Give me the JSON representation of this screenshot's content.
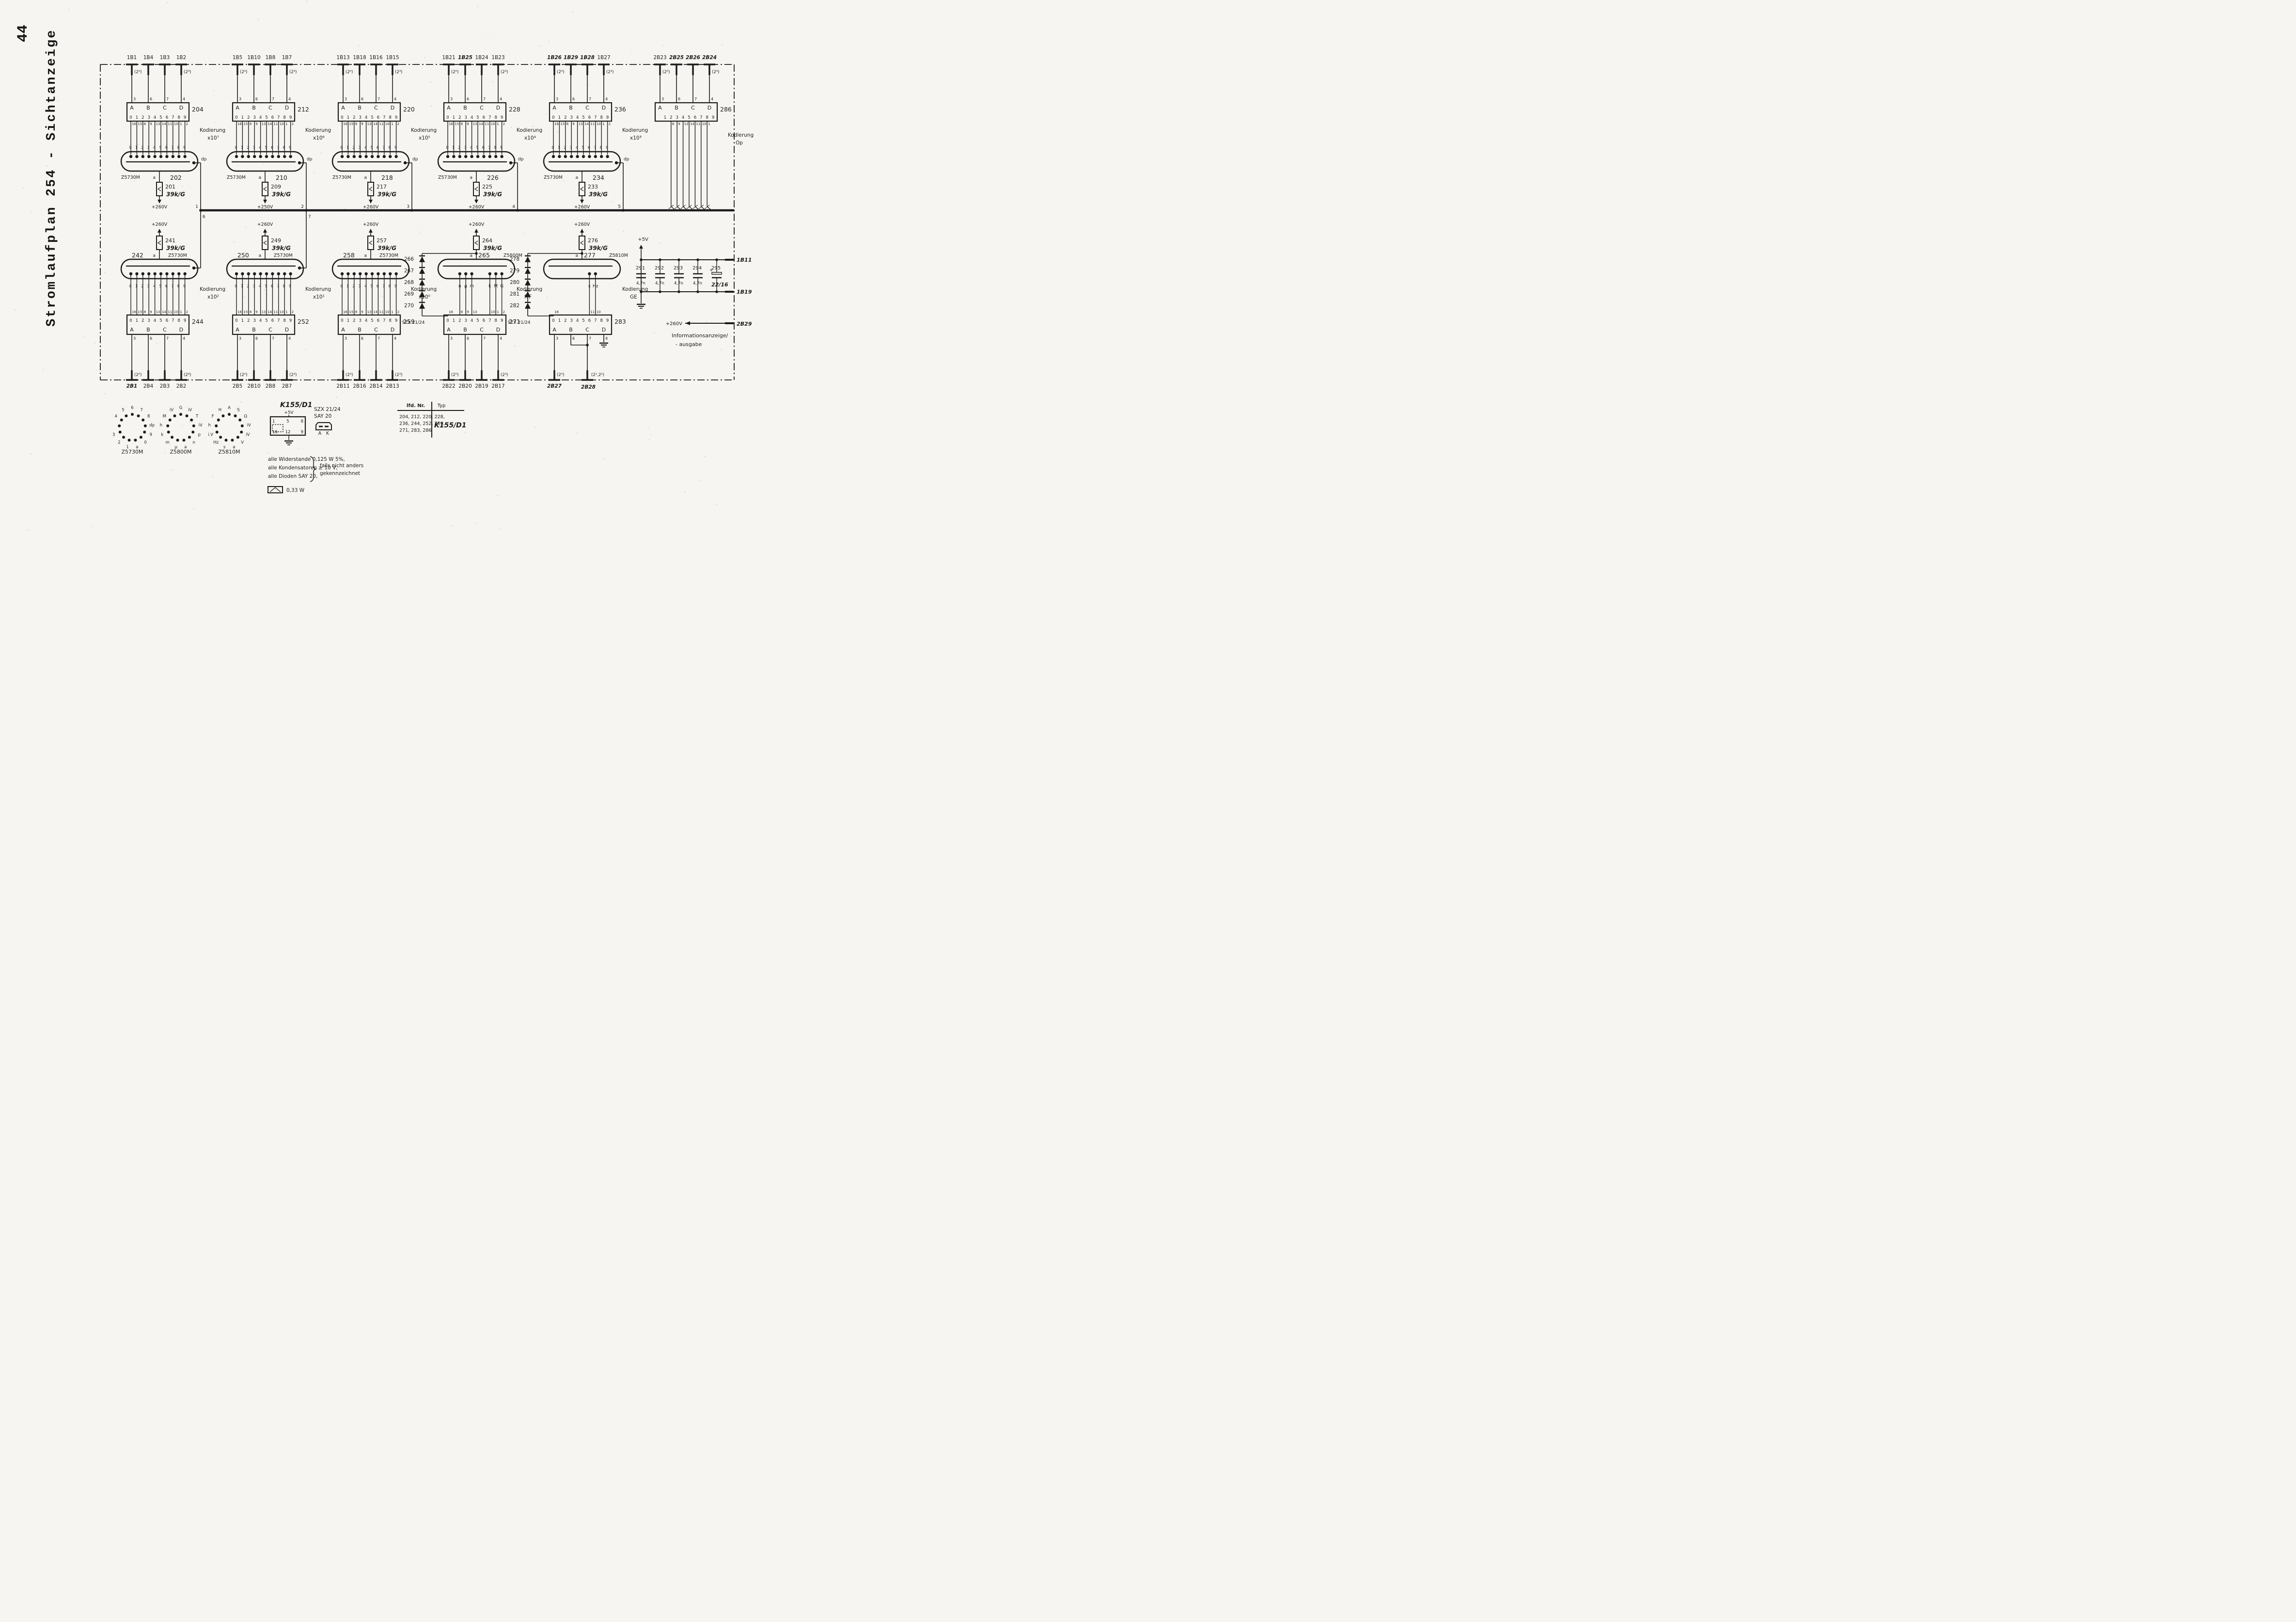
{
  "page": {
    "number": "44",
    "title": "Stromlaufplan 254  -  Sichtanzeige"
  },
  "colors": {
    "ink": "#1c1c1c",
    "paper": "#f6f5f1"
  },
  "handwritten": [
    "1B25",
    "1B26",
    "1B29",
    "1B28",
    "2B25",
    "2B26",
    "2B24",
    "2B1",
    "2B27",
    "2B28",
    "1B11",
    "1B19",
    "2B29",
    "22/16",
    "K155/D1",
    "39k/G"
  ],
  "shared": {
    "digits": [
      "0",
      "1",
      "2",
      "3",
      "4",
      "5",
      "6",
      "7",
      "8",
      "9"
    ],
    "digits9": [
      "1",
      "2",
      "3",
      "4",
      "5",
      "6",
      "7",
      "8",
      "9"
    ],
    "abcd": [
      "A",
      "B",
      "C",
      "D"
    ],
    "abcd_pins": [
      "3",
      "6",
      "7",
      "4"
    ],
    "decoder_out_pins": [
      "16",
      "15",
      "8",
      "9",
      "13",
      "14",
      "11",
      "10",
      "1",
      "2"
    ],
    "kodierung_word": "Kodierung",
    "dp": "dp",
    "anode": "a"
  },
  "bus": {
    "junctions_top": [
      "1",
      "2",
      "3",
      "4",
      "5"
    ],
    "junctions_bottom": [
      "6",
      "7"
    ]
  },
  "top_groups": [
    {
      "block": "204",
      "inputs": [
        "1B1",
        "1B4",
        "1B3",
        "1B2"
      ],
      "exp_first": "(2⁰)",
      "exp_last": "(2³)",
      "kodierung": "x10⁷",
      "tube_id": "202",
      "tube_type": "Z5730M",
      "res_id": "201",
      "res_val": "39k/G",
      "supply": "+260V",
      "junction": "1"
    },
    {
      "block": "212",
      "inputs": [
        "1B5",
        "1B10",
        "1B8",
        "1B7"
      ],
      "exp_first": "(2⁰)",
      "exp_last": "(2³)",
      "kodierung": "x10⁶",
      "tube_id": "210",
      "tube_type": "Z5730M",
      "res_id": "209",
      "res_val": "39k/G",
      "supply": "+250V",
      "junction": "2"
    },
    {
      "block": "220",
      "inputs": [
        "1B13",
        "1B18",
        "1B16",
        "1B15"
      ],
      "exp_first": "(2⁰)",
      "exp_last": "(2³)",
      "kodierung": "x10⁵",
      "tube_id": "218",
      "tube_type": "Z5730M",
      "res_id": "217",
      "res_val": "39k/G",
      "supply": "+260V",
      "junction": "3"
    },
    {
      "block": "228",
      "inputs": [
        "1B21",
        "1B25",
        "1B24",
        "1B23"
      ],
      "exp_first": "(2⁰)",
      "exp_last": "(2³)",
      "kodierung": "x10⁴",
      "tube_id": "226",
      "tube_type": "Z5730M",
      "res_id": "225",
      "res_val": "39k/G",
      "supply": "+260V",
      "junction": "4"
    },
    {
      "block": "236",
      "inputs": [
        "1B26",
        "1B29",
        "1B28",
        "1B27"
      ],
      "exp_first": "(2⁰)",
      "exp_last": "(2³)",
      "kodierung": "x10³",
      "tube_id": "234",
      "tube_type": "Z5730M",
      "res_id": "233",
      "res_val": "39k/G",
      "supply": "+260V",
      "junction": "5"
    },
    {
      "block": "286",
      "inputs": [
        "2B23",
        "2B25",
        "2B26",
        "2B24"
      ],
      "exp_first": "(2⁰)",
      "exp_last": "(2³)",
      "kodierung": "Op",
      "no_tube": true,
      "out_pins": [
        "8",
        "9",
        "13",
        "14",
        "11",
        "10",
        "1"
      ]
    }
  ],
  "bottom_groups": [
    {
      "block": "244",
      "outputs": [
        "2B1",
        "2B4",
        "2B3",
        "2B2"
      ],
      "exp_first": "(2⁰)",
      "exp_last": "(2³)",
      "kodierung": "x10²",
      "tube_id": "242",
      "tube_type": "Z5730M",
      "res_id": "241",
      "res_val": "39k/G",
      "supply": "+260V",
      "junction": "6"
    },
    {
      "block": "252",
      "outputs": [
        "2B5",
        "2B10",
        "2B8",
        "2B7"
      ],
      "exp_first": "(2⁰)",
      "exp_last": "(2³)",
      "kodierung": "x10¹",
      "tube_id": "250",
      "tube_type": "Z5730M",
      "res_id": "249",
      "res_val": "39k/G",
      "supply": "+260V",
      "junction": "7"
    },
    {
      "block": "259",
      "outputs": [
        "2B11",
        "2B16",
        "2B14",
        "2B13"
      ],
      "exp_first": "(2⁰)",
      "exp_last": "(2³)",
      "kodierung": "x10⁰",
      "tube_id": "258",
      "tube_type": "Z5730M",
      "res_id": "257",
      "res_val": "39k/G",
      "supply": "+260V"
    },
    {
      "block": "271",
      "outputs": [
        "2B22",
        "2B20",
        "2B19",
        "2B17"
      ],
      "exp_first": "(2⁰)",
      "exp_last": "(2³)",
      "kodierung": "MF",
      "tube_id": "265",
      "tube_type": "Z5800M",
      "res_id": "264",
      "res_val": "39k/G",
      "supply": "+260V",
      "cathodes": [
        "n",
        "μ",
        "m",
        "k",
        "M",
        "G"
      ],
      "cathode_pos": [
        2,
        3,
        4,
        7,
        8,
        9
      ],
      "cathode_pins": [
        "8",
        "9",
        "13",
        "10",
        "1",
        "2"
      ],
      "diodes": [
        "266",
        "267",
        "268",
        "269",
        "270"
      ],
      "diode_type": "SZX 21/24",
      "diode_pin": "16"
    },
    {
      "block": "283",
      "outputs": [
        "2B27",
        "2B28"
      ],
      "output_exps": [
        "(2⁰)",
        "(2¹,2²)"
      ],
      "kodierung": "GE",
      "tube_id": "277",
      "tube_type": "Z5810M",
      "res_id": "276",
      "res_val": "39k/G",
      "supply": "+260V",
      "cathodes": [
        "s",
        "Hz"
      ],
      "cathode_pos": [
        6,
        7
      ],
      "cathode_pins": [
        "11",
        "10"
      ],
      "diodes": [
        "278",
        "279",
        "280",
        "281",
        "282"
      ],
      "diode_type": "SZX 21/24",
      "diode_pin": "16",
      "ground_pin": "4"
    }
  ],
  "right_section": {
    "supply": "+5V",
    "caps": [
      {
        "id": "291",
        "value": "4,7n"
      },
      {
        "id": "292",
        "value": "4,7n"
      },
      {
        "id": "293",
        "value": "4,7n"
      },
      {
        "id": "294",
        "value": "4,7n"
      },
      {
        "id": "295",
        "value": "22/16",
        "polarized": true,
        "plus": "+"
      }
    ],
    "rail_top": "1B11",
    "rail_bottom": "1B19",
    "hv_label": "+260V",
    "hv_pin": "2B29",
    "info_lines": [
      "Informationsanzeige/",
      "- ausgabe"
    ]
  },
  "legend": {
    "tubes": [
      {
        "name": "Z5730M",
        "pins_cw": [
          "6",
          "7",
          "8",
          "dp",
          "9",
          "0",
          "a",
          "1",
          "2",
          "3",
          "",
          "4",
          "5"
        ]
      },
      {
        "name": "Z5800M",
        "pins_cw": [
          "G",
          "iV",
          "T",
          "iV",
          "p",
          "n",
          "a",
          "μ",
          "m",
          "k",
          "h",
          "M",
          "iV"
        ]
      },
      {
        "name": "Z5810M",
        "pins_cw": [
          "A",
          "S",
          "Ω",
          "iV",
          "iV",
          "V",
          "a",
          "s",
          "Hz",
          "i.V",
          "h",
          "F",
          "H"
        ]
      }
    ],
    "ic": {
      "name": "K155/D1",
      "supply": "+5V",
      "pins_top": [
        "1",
        "5",
        "8"
      ],
      "pins_bottom": [
        "16",
        "12",
        "9"
      ]
    },
    "diode_legend": {
      "line1": "SZX 21/24",
      "line2": "SAY 20",
      "anode": "A",
      "cathode": "K"
    },
    "table": {
      "col1": "lfd. Nr.",
      "col2": "Typ",
      "rows": [
        "204, 212, 220, 228,",
        "236, 244, 252, 259,",
        "271, 283, 286"
      ],
      "typ": "K155/D1"
    },
    "notes": {
      "lines": [
        "alle Widerstande  0,125 W  5%,",
        "alle Kondensatoren ≥ 10 V,",
        "alle Dioden  SAY 20,"
      ],
      "brace_lines": [
        "falls nicht anders",
        "gekennzeichnet"
      ],
      "power_symbol_label": "0,33 W"
    }
  }
}
